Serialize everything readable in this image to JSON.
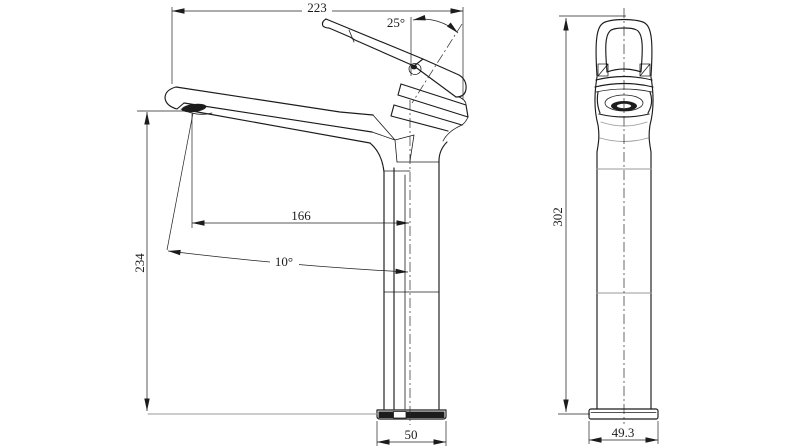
{
  "drawing": {
    "background": "#ffffff",
    "line_color": "#1c1c1c",
    "light_line_color": "#9a9a9a",
    "views": {
      "side": {
        "dimensions": {
          "overall_width": "223",
          "handle_angle": "25°",
          "spout_reach": "166",
          "spout_angle": "10°",
          "spout_height": "234",
          "base_width": "50"
        }
      },
      "front": {
        "dimensions": {
          "overall_height": "302",
          "base_width": "49.3"
        }
      }
    }
  }
}
